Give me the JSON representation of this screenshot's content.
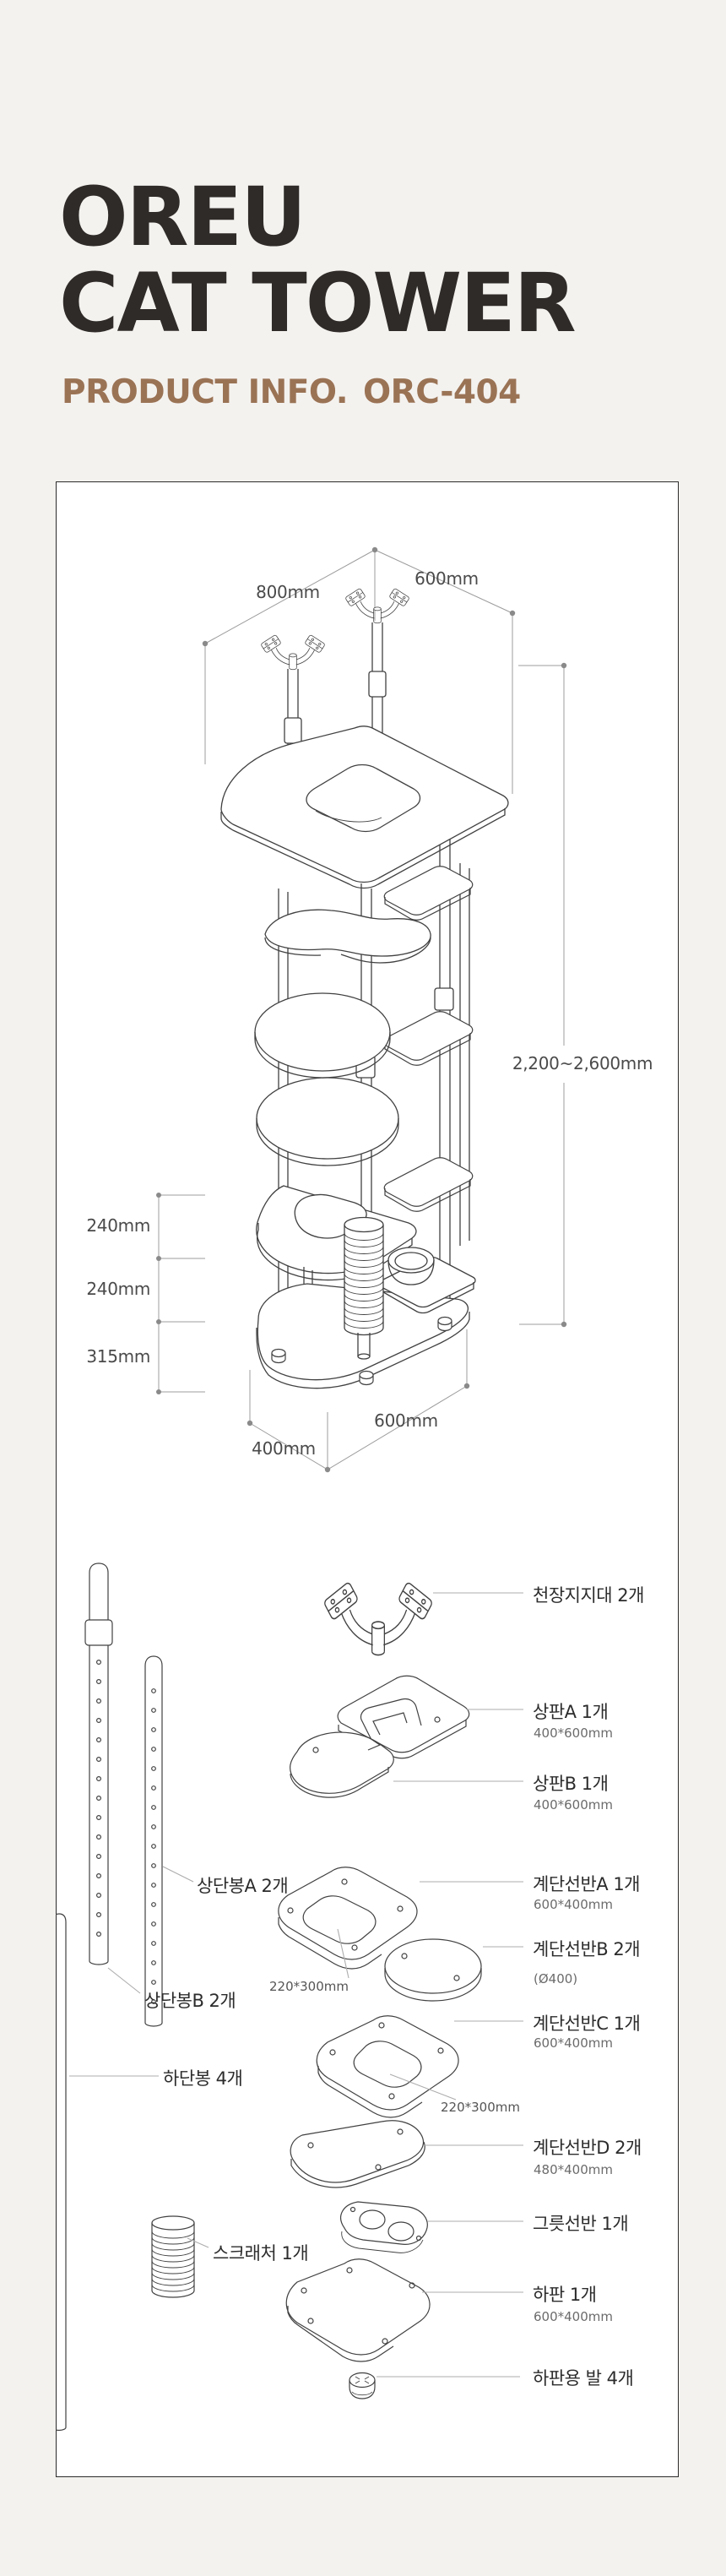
{
  "header": {
    "title_line1": "OREU",
    "title_line2": "CAT TOWER",
    "subtitle_label": "PRODUCT INFO.",
    "product_code": "ORC-404"
  },
  "colors": {
    "background": "#f4f2ef",
    "title_ink": "#2e2b28",
    "subtitle_brown": "#9a7355",
    "panel_border": "#2b2b2b",
    "line_art": "#414141",
    "dimension_gray": "#9c9c9c"
  },
  "diagram": {
    "dim_top_width": "800mm",
    "dim_top_depth": "600mm",
    "dim_height": "2,200~2,600mm",
    "dim_gap1": "240mm",
    "dim_gap2": "240mm",
    "dim_gap3": "315mm",
    "dim_base_width": "600mm",
    "dim_base_depth": "400mm"
  },
  "parts_right": [
    {
      "name": "천장지지대 2개",
      "size": ""
    },
    {
      "name": "상판A 1개",
      "size": "400*600mm"
    },
    {
      "name": "상판B 1개",
      "size": "400*600mm"
    },
    {
      "name": "계단선반A 1개",
      "size": "600*400mm"
    },
    {
      "name": "계단선반B 2개",
      "size": "(Ø400)"
    },
    {
      "name": "계단선반C 1개",
      "size": "600*400mm"
    },
    {
      "name": "계단선반D 2개",
      "size": "480*400mm"
    },
    {
      "name": "그릇선반 1개",
      "size": ""
    },
    {
      "name": "하판 1개",
      "size": "600*400mm"
    },
    {
      "name": "하판용 발 4개",
      "size": ""
    }
  ],
  "parts_left": [
    {
      "name": "상단봉A 2개"
    },
    {
      "name": "상단봉B 2개"
    },
    {
      "name": "하단봉 4개"
    },
    {
      "name": "스크래처 1개"
    }
  ],
  "annotations": [
    {
      "text": "220*300mm"
    },
    {
      "text": "220*300mm"
    }
  ]
}
